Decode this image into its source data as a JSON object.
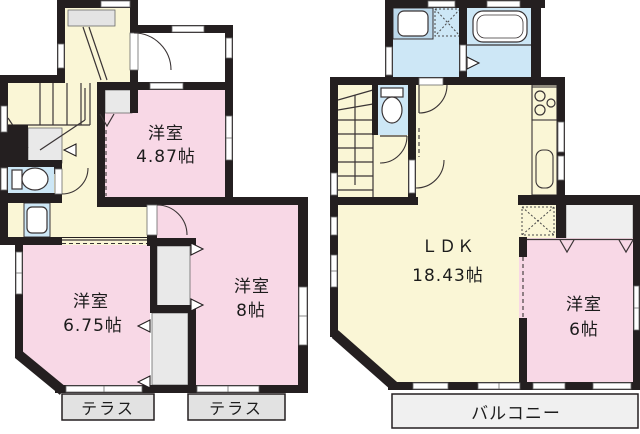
{
  "floor1": {
    "room1": {
      "name": "洋室",
      "size": "4.87帖"
    },
    "room2": {
      "name": "洋室",
      "size": "6.75帖"
    },
    "room3": {
      "name": "洋室",
      "size": "8帖"
    },
    "terrace_left": "テラス",
    "terrace_right": "テラス"
  },
  "floor2": {
    "ldk": {
      "name": "ＬＤＫ",
      "size": "18.43帖"
    },
    "room": {
      "name": "洋室",
      "size": "6帖"
    },
    "balcony": "バルコニー"
  },
  "colors": {
    "wall": "#241f20",
    "room_pink": "#f8d8e6",
    "hall_cream": "#faf6d6",
    "wet_blue": "#cde7f6",
    "closet_gray": "#e9e9e9",
    "terrace_gray": "#e2e2e2",
    "balcony_gray": "#f0f0f0"
  }
}
